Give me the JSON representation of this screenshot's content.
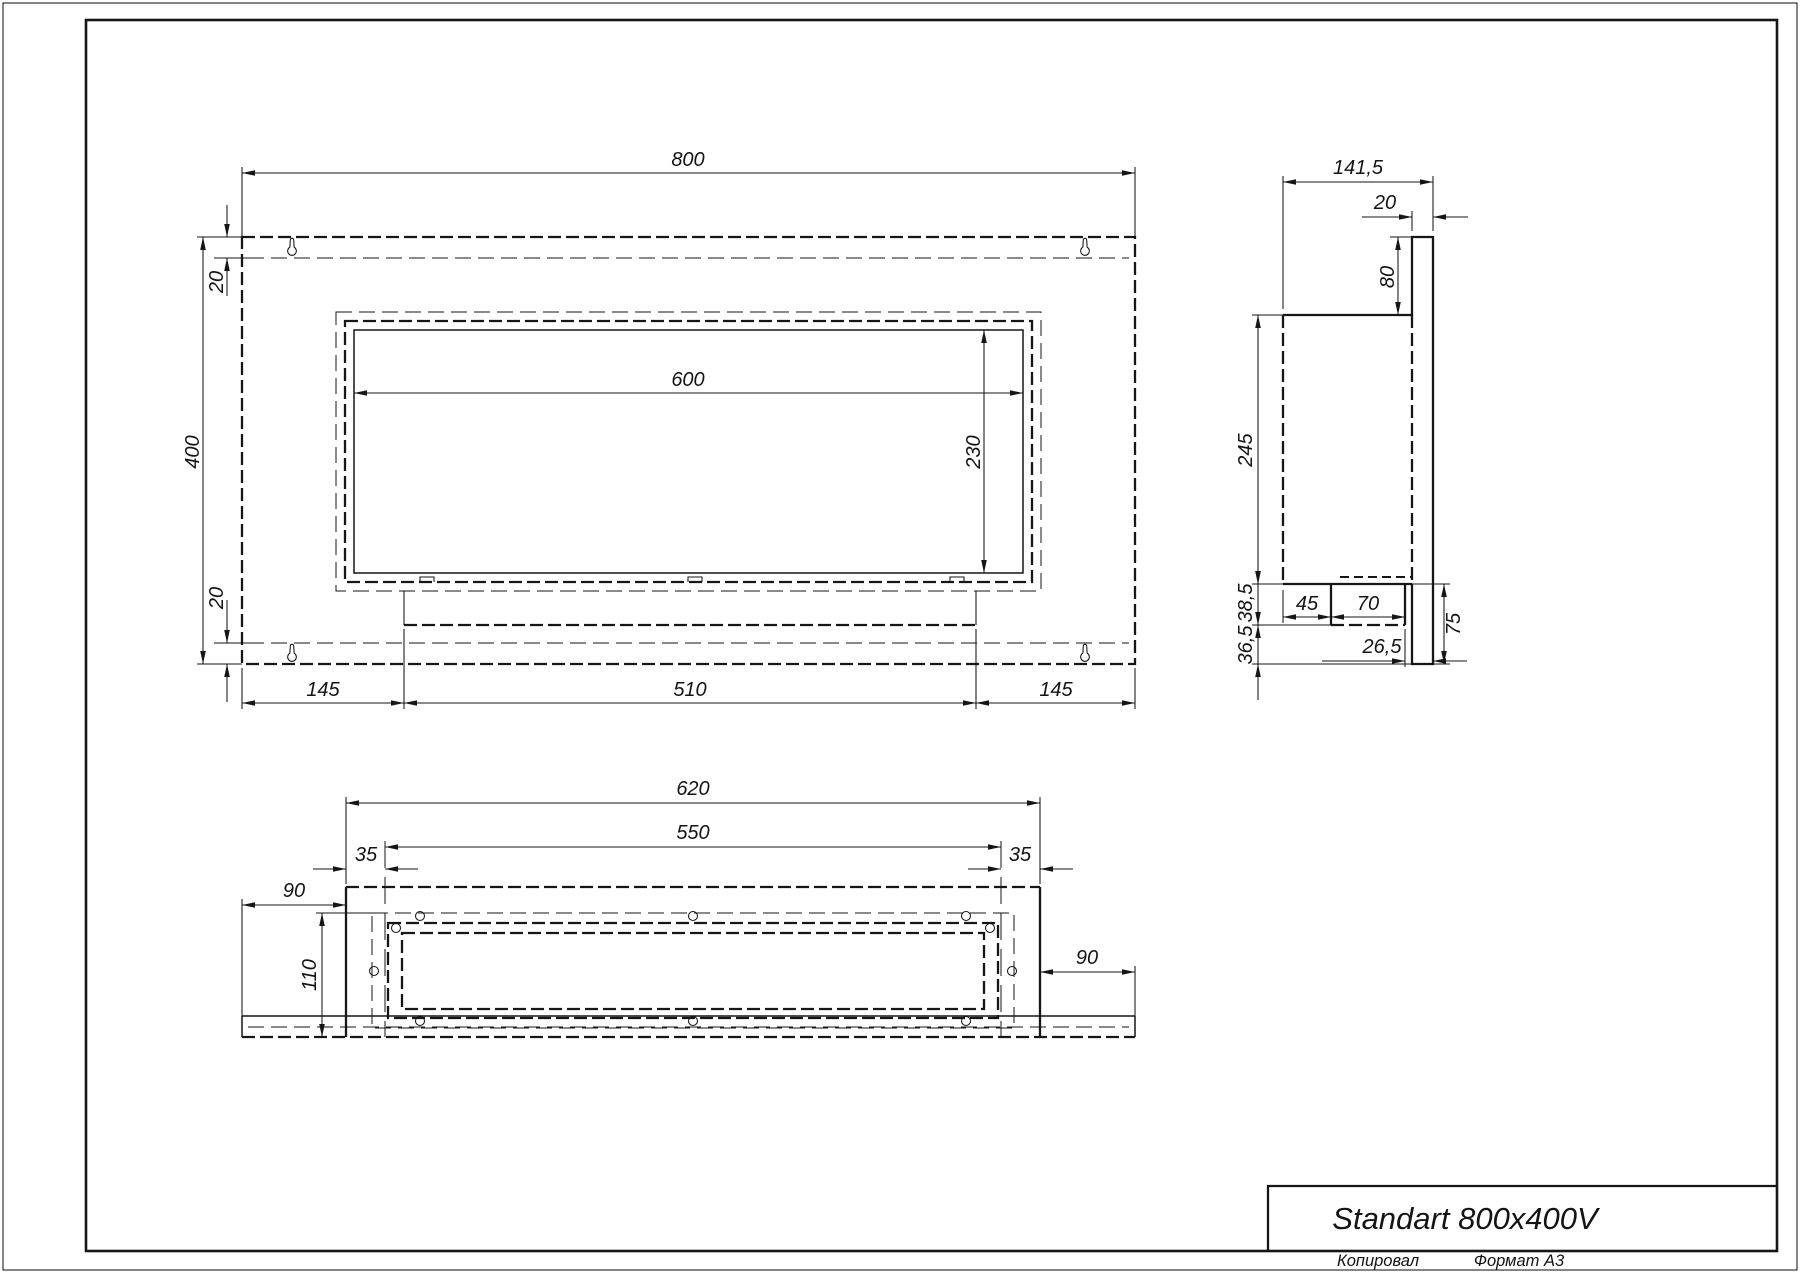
{
  "title_block": {
    "title": "Standart 800x400V",
    "copied_label": "Копировал",
    "format_label": "Формат А3"
  },
  "front_view": {
    "dims": {
      "width": "800",
      "height": "400",
      "top_flange": "20",
      "bottom_flange": "20",
      "opening_width": "600",
      "opening_height": "230",
      "left_margin": "145",
      "tray_width": "510",
      "right_margin": "145"
    }
  },
  "side_view": {
    "dims": {
      "depth": "141,5",
      "panel_thickness": "20",
      "top_extension": "80",
      "body_height": "245",
      "tray_drop": "38,5",
      "bottom_gap": "36,5",
      "tray_offset": "45",
      "tray_depth": "70",
      "rear_clearance": "26,5",
      "bottom_extension": "75"
    }
  },
  "bottom_view": {
    "dims": {
      "body_width": "620",
      "inner_width": "550",
      "left_inset": "35",
      "right_inset": "35",
      "left_overhang": "90",
      "right_overhang": "90",
      "depth": "110"
    }
  }
}
